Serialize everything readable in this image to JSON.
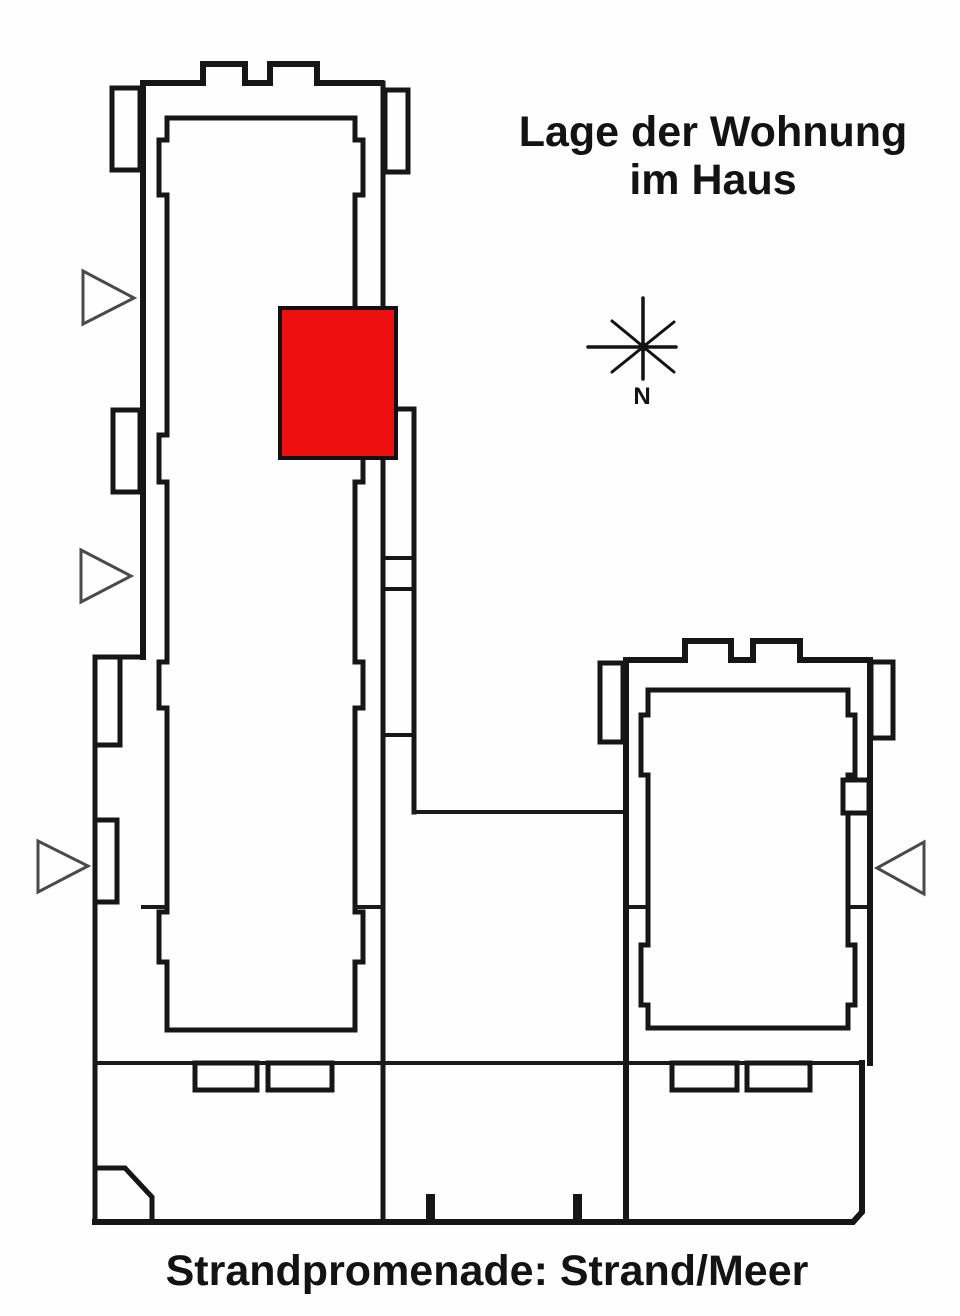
{
  "plan": {
    "title_line1": "Lage der Wohnung",
    "title_line2": "im Haus",
    "caption": "Strandpromenade: Strand/Meer",
    "compass_label": "N",
    "marker_color": "#ee1010",
    "wall_color": "#161616",
    "arrow_color": "#4a4a4a",
    "text_color": "#131313",
    "background_color": "#fefefe",
    "icons": {
      "compass": "compass-rose-icon",
      "entrance_arrows_left": 3,
      "entrance_arrows_right": 1
    }
  }
}
